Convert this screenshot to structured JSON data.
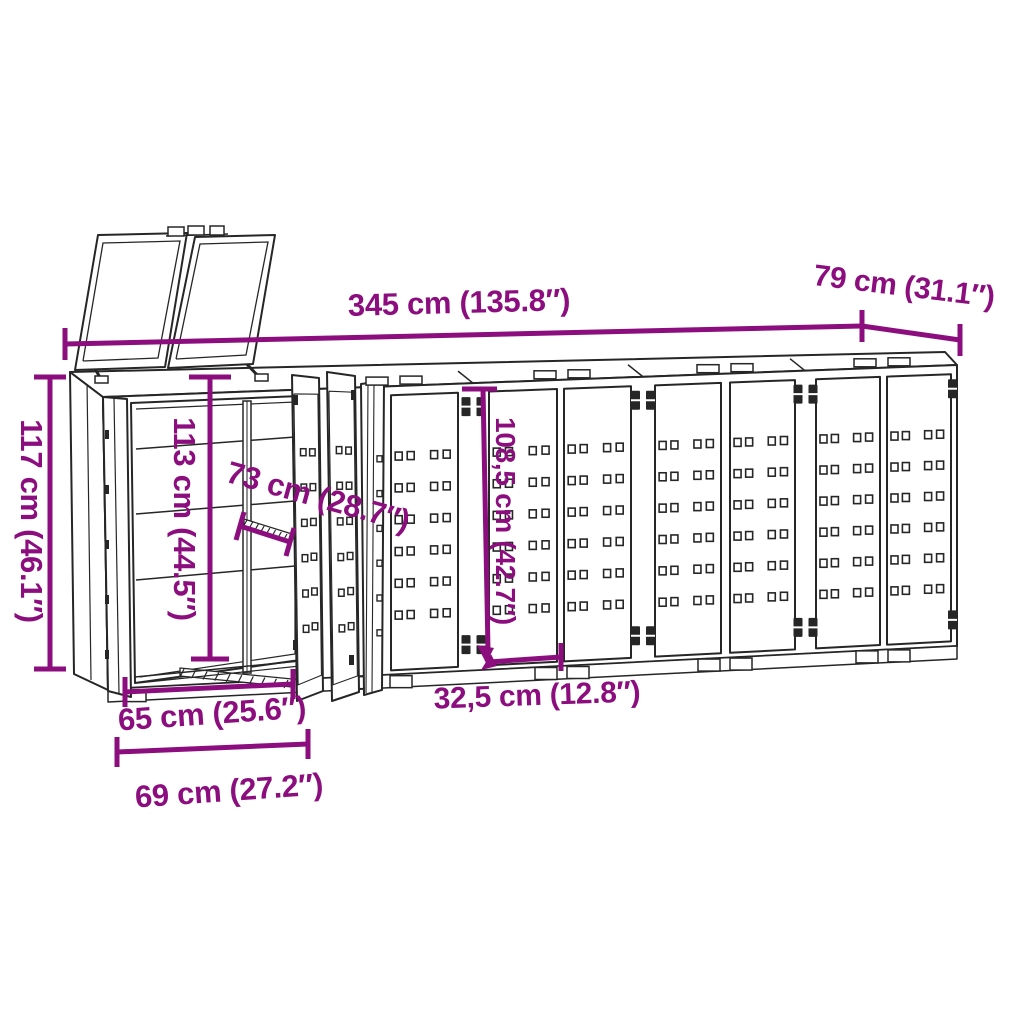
{
  "colors": {
    "accent": "#8C0E7E",
    "line": "#262626",
    "background": "#FFFFFF"
  },
  "dimensions": {
    "overall_width": "345 cm (135.8″)",
    "depth": "79 cm (31.1″)",
    "overall_height": "117 cm (46.1″)",
    "inner_height": "113 cm (44.5″)",
    "inner_depth": "73 cm (28.7″)",
    "door_height": "108,5 cm (42.7″)",
    "door_half_width": "32,5 cm (12.8″)",
    "opening_width": "65 cm (25.6″)",
    "module_width": "69 cm (27.2″)"
  }
}
